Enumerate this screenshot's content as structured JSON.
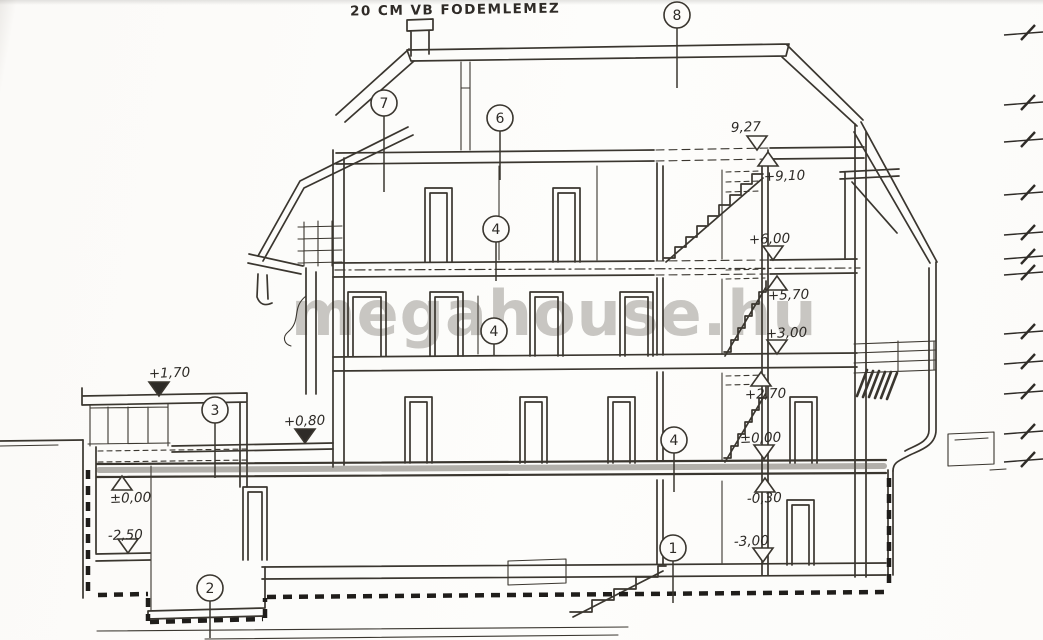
{
  "colors": {
    "paper": "#fdfdfb",
    "ink": "#3a362f",
    "watermark": "#c8c6c2"
  },
  "note": {
    "text": "20 CM VB FODEMLEMEZ"
  },
  "watermark": {
    "text": "megahouse.hu"
  },
  "elevation_markers": [
    {
      "label": "9,27",
      "lx": 731,
      "ly": 132,
      "tx": 757,
      "ty": 150,
      "dir": "down",
      "filled": false
    },
    {
      "label": "+9,10",
      "lx": 764,
      "ly": 181,
      "tx": 768,
      "ty": 152,
      "dir": "up",
      "filled": false
    },
    {
      "label": "+6,00",
      "lx": 749,
      "ly": 244,
      "tx": 773,
      "ty": 260,
      "dir": "down",
      "filled": false
    },
    {
      "label": "+5,70",
      "lx": 768,
      "ly": 300,
      "tx": 777,
      "ty": 276,
      "dir": "up",
      "filled": false
    },
    {
      "label": "+3,00",
      "lx": 766,
      "ly": 338,
      "tx": 777,
      "ty": 354,
      "dir": "down",
      "filled": false
    },
    {
      "label": "+2,70",
      "lx": 745,
      "ly": 399,
      "tx": 761,
      "ty": 372,
      "dir": "up",
      "filled": false
    },
    {
      "label": "±0,00",
      "lx": 740,
      "ly": 443,
      "tx": 764,
      "ty": 459,
      "dir": "down",
      "filled": false
    },
    {
      "label": "-0,30",
      "lx": 747,
      "ly": 503,
      "tx": 765,
      "ty": 478,
      "dir": "up",
      "filled": false
    },
    {
      "label": "-3,00",
      "lx": 734,
      "ly": 546,
      "tx": 763,
      "ty": 562,
      "dir": "down",
      "filled": false
    },
    {
      "label": "+1,70",
      "lx": 149,
      "ly": 378,
      "tx": 159,
      "ty": 396,
      "dir": "down",
      "filled": true
    },
    {
      "label": "+0,80",
      "lx": 284,
      "ly": 426,
      "tx": 305,
      "ty": 443,
      "dir": "down",
      "filled": true
    },
    {
      "label": "±0,00",
      "lx": 110,
      "ly": 503,
      "tx": 122,
      "ty": 476,
      "dir": "up",
      "filled": false
    },
    {
      "label": "-2,50",
      "lx": 108,
      "ly": 540,
      "tx": 128,
      "ty": 553,
      "dir": "down",
      "filled": false
    }
  ],
  "reference_bubbles": [
    {
      "label": "8",
      "cx": 677,
      "cy": 15,
      "ly2": 88
    },
    {
      "label": "7",
      "cx": 384,
      "cy": 103,
      "ly2": 192
    },
    {
      "label": "6",
      "cx": 500,
      "cy": 118,
      "ly2": 180
    },
    {
      "label": "4",
      "cx": 496,
      "cy": 229,
      "ly2": 281
    },
    {
      "label": "4",
      "cx": 494,
      "cy": 331,
      "ly2": 356
    },
    {
      "label": "4",
      "cx": 674,
      "cy": 440,
      "ly2": 492
    },
    {
      "label": "3",
      "cx": 215,
      "cy": 410,
      "ly2": 478
    },
    {
      "label": "2",
      "cx": 210,
      "cy": 588,
      "ly2": 638
    },
    {
      "label": "1",
      "cx": 673,
      "cy": 548,
      "ly2": 603
    }
  ],
  "dimension_ticks": {
    "ys": [
      33,
      103,
      140,
      193,
      233,
      257,
      273,
      332,
      362,
      392,
      432,
      460
    ]
  }
}
